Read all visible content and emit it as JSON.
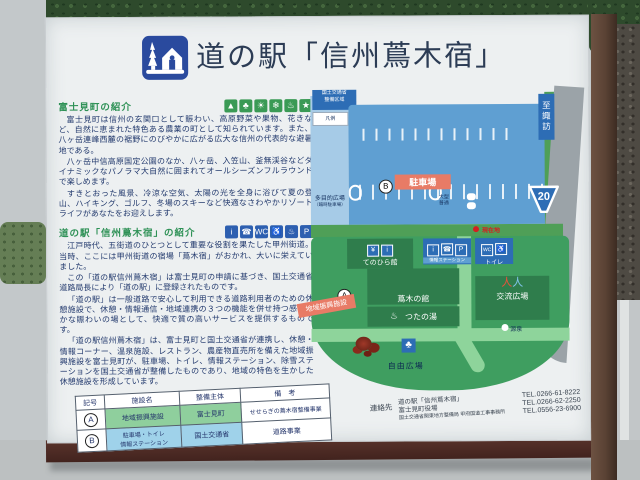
{
  "sign": {
    "title": "道の駅「信州蔦木宿」",
    "town": {
      "heading": "富士見町の紹介",
      "icons": [
        "▲",
        "♣",
        "☀",
        "❄",
        "♨",
        "★"
      ],
      "p1": "富士見町は信州の玄関口として賑わい、高原野菜や果物、花きなど、自然に恵まれた特色ある農業の町として知られています。また、八ヶ岳連峰西麓の裾野にのびやかに広がる広大な信州の代表的な避暑地である。",
      "p2": "八ヶ岳中信高原国定公園のなか、八ヶ岳、入笠山、釜無渓谷などダイナミックなパノラマ大自然に囲まれてオールシーズンフルラウンドで楽しめます。",
      "p3": "すきとおった風景、冷涼な空気、太陽の光を全身に浴びて夏の登山、ハイキング、ゴルフ、冬場のスキーなど快適なさわやかリゾートライフがあなたをお迎えします。"
    },
    "station": {
      "heading": "道の駅「信州蔦木宿」の紹介",
      "icons": [
        "i",
        "☎",
        "WC",
        "♿",
        "♨",
        "P"
      ],
      "p1": "江戸時代、五街道のひとつとして重要な役割を果たした甲州街道。当時、ここには甲州街道の宿場「蔦木宿」がおかれ、大いに栄えていました。",
      "p2": "この「道の駅信州蔦木宿」は富士見町の申請に基づき、国土交通省道路局長により「道の駅」に登録されたものです。",
      "p3": "「道の駅」は一般道路で安心して利用できる道路利用者のための休憩施設で、休憩・情報通信・地域連携の３つの機能を併せ持つ感性豊かな賑わいの場として、快適で質の高いサービスを提供するものです。",
      "p4": "「道の駅信州蔦木宿」は、富士見町と国土交通省が連携し、休憩・情報コーナー、温泉施設、レストラン、農産物直売所を備えた地域振興施設を富士見町が、駐車場、トイレ、情報ステーション、除雪ステーションを国土交通省が整備したものであり、地域の特色を生かした休憩施設を形成しています。"
    },
    "table": {
      "headers": [
        "記号",
        "施設名",
        "整備主体",
        "備　考"
      ],
      "rows": [
        {
          "mark": "A",
          "facility": "地域振興施設",
          "agency": "富士見町",
          "note": "せせらぎの蔦木宿整備事業"
        },
        {
          "mark": "B",
          "facility_line1": "駐車場・トイレ",
          "facility_line2": "情報ステーション",
          "agency": "国土交通省",
          "note": "道路事業"
        }
      ]
    },
    "map": {
      "legend_box": {
        "line1": "国土交通省",
        "line2": "整備区域"
      },
      "legend_note": "凡例",
      "multipurpose": {
        "line1": "多目的広場",
        "line2": "（臨時駐車場）"
      },
      "parking": {
        "mark": "B",
        "label": "駐車場",
        "size1": "大型",
        "size2": "普通"
      },
      "current_location": "現在地",
      "to_suwa": "至諏訪",
      "route_number": "20",
      "to_kofu": "至甲府",
      "facilities": {
        "tenohira": "てのひら館",
        "info_station": "情報ステーション",
        "toilet": "トイレ",
        "tsutaki_hall": "蔦木の館",
        "tsutanoyu": "つたの湯",
        "koryu_plaza": "交流広場",
        "gensen": "源泉",
        "jiyu_plaza": "自由広場",
        "chiiki_label": "地域振興施設",
        "a_mark": "A"
      }
    },
    "contacts": {
      "label": "連絡先",
      "entries": [
        {
          "name": "道の駅「信州蔦木宿」",
          "tel": "TEL.0266-61-8222"
        },
        {
          "name": "富士見町役場",
          "tel": "TEL.0266-62-2250"
        },
        {
          "name": "国土交通省関東地方整備局 甲府国道工事事務所",
          "tel": "TEL.0556-23-6900"
        }
      ]
    }
  }
}
